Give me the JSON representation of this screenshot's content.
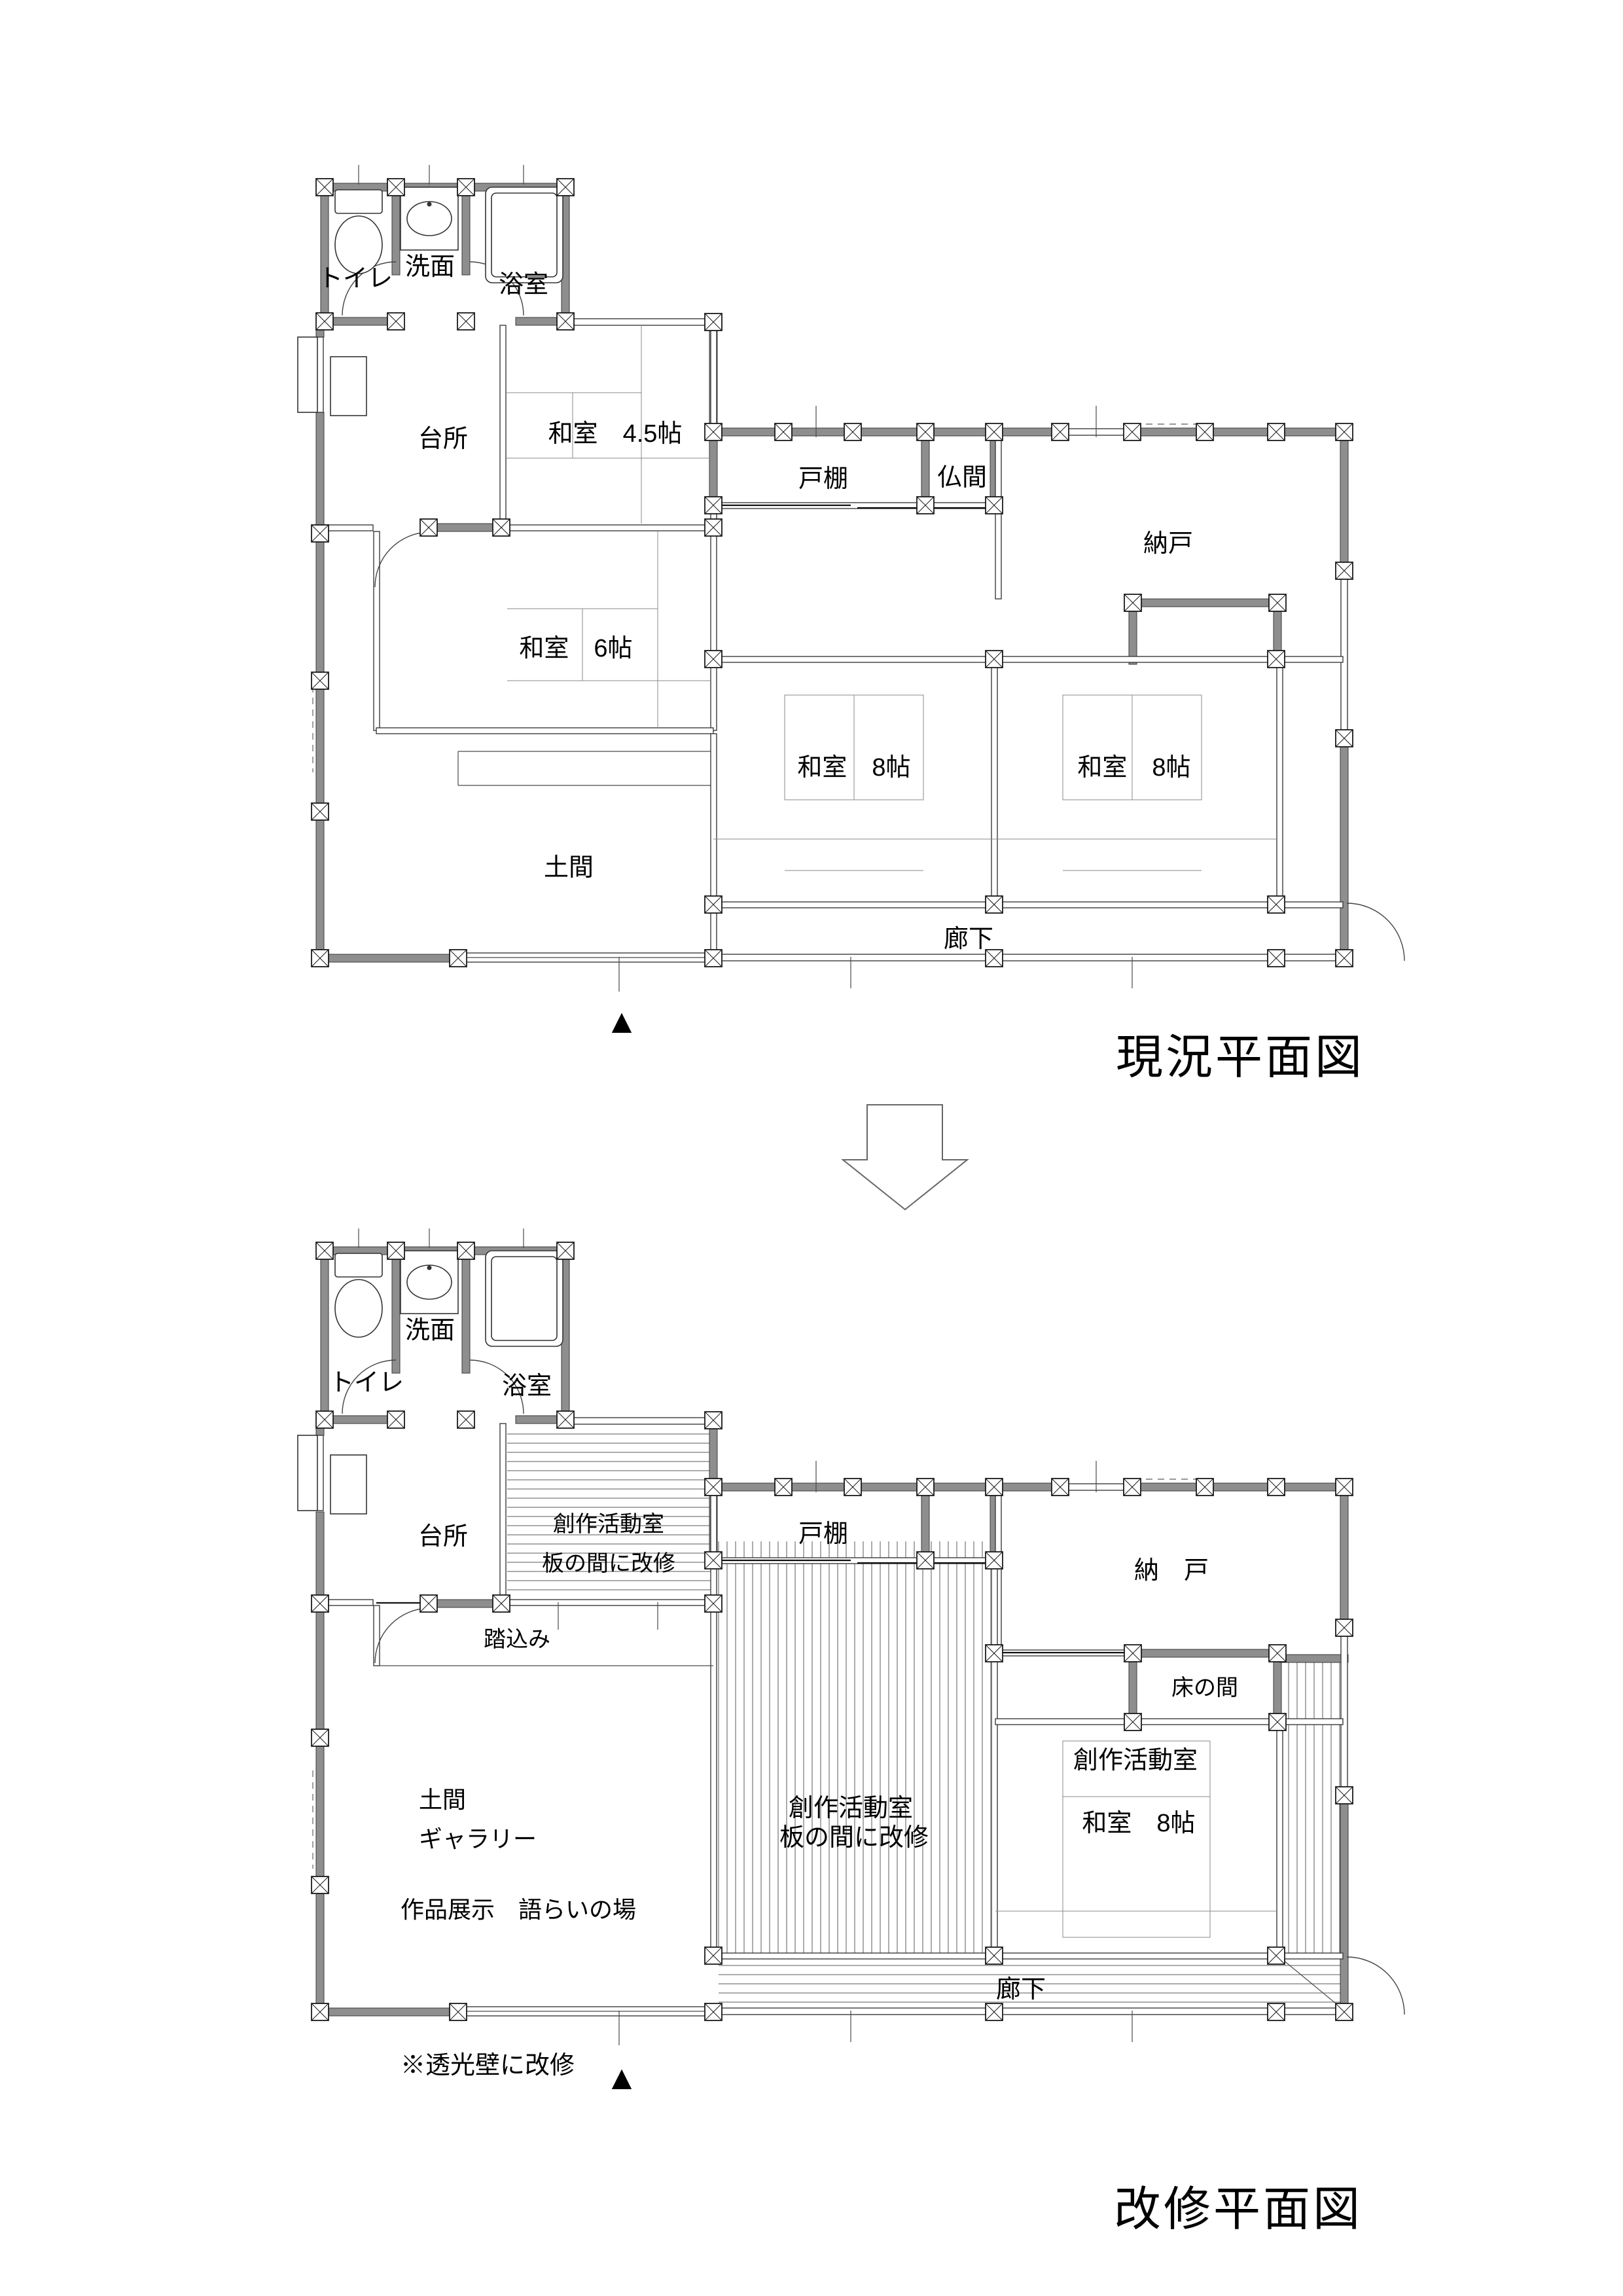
{
  "document": {
    "background": "#ffffff",
    "wall_color": "#8e8e8e",
    "line_color": "#3a3a3a"
  },
  "current": {
    "title": "現況平面図",
    "entrance_marker": "▲",
    "rooms": {
      "toilet": "トイレ",
      "washroom": "洗面",
      "bath": "浴室",
      "kitchen": "台所",
      "washitsu_45": "和室　4.5帖",
      "todana": "戸棚",
      "butsuma": "仏間",
      "nando": "納戸",
      "washitsu_6": "和室　6帖",
      "washitsu_8_left": "和室　8帖",
      "washitsu_8_right": "和室　8帖",
      "doma": "土間",
      "rouka": "廊下"
    }
  },
  "renovated": {
    "title": "改修平面図",
    "entrance_marker": "▲",
    "note": "※透光壁に改修",
    "rooms": {
      "toilet": "トイレ",
      "washroom": "洗面",
      "bath": "浴室",
      "kitchen": "台所",
      "sousaku_north_1": "創作活動室",
      "sousaku_north_2": "板の間に改修",
      "todana": "戸棚",
      "nando": "納　戸",
      "fumikomi": "踏込み",
      "tokonoma": "床の間",
      "doma": "土間",
      "gallery": "ギャラリー",
      "exhibit": "作品展示　語らいの場",
      "sousaku_center_1": "創作活動室",
      "sousaku_center_2": "板の間に改修",
      "sousaku_east": "創作活動室",
      "washitsu_8": "和室　8帖",
      "rouka": "廊下"
    }
  }
}
